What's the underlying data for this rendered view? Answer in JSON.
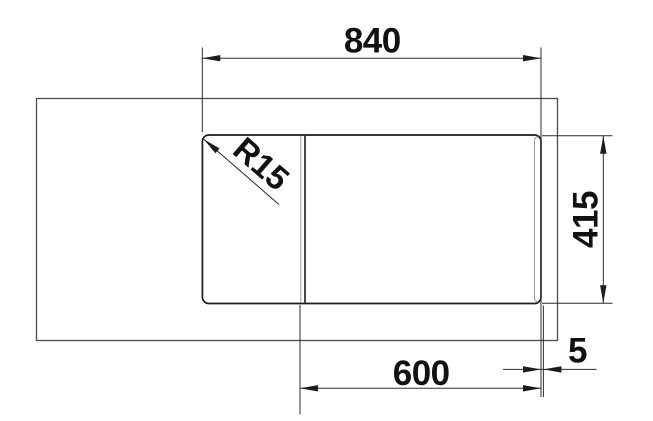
{
  "drawing": {
    "kind": "technical-dimension-drawing",
    "subject": "sink top view with worktop and installation dimensions",
    "labels": {
      "top_width": "840",
      "right_height": "415",
      "bottom_width": "600",
      "right_offset": "5",
      "corner_radius": "R15"
    },
    "colors": {
      "background": "#ffffff",
      "outline_dark": "#1c1c1c",
      "outline_medium": "#4c4c4c",
      "outline_light": "#9a9a9a",
      "dimension_lines": "#2d2d2d",
      "text": "#111111"
    }
  }
}
